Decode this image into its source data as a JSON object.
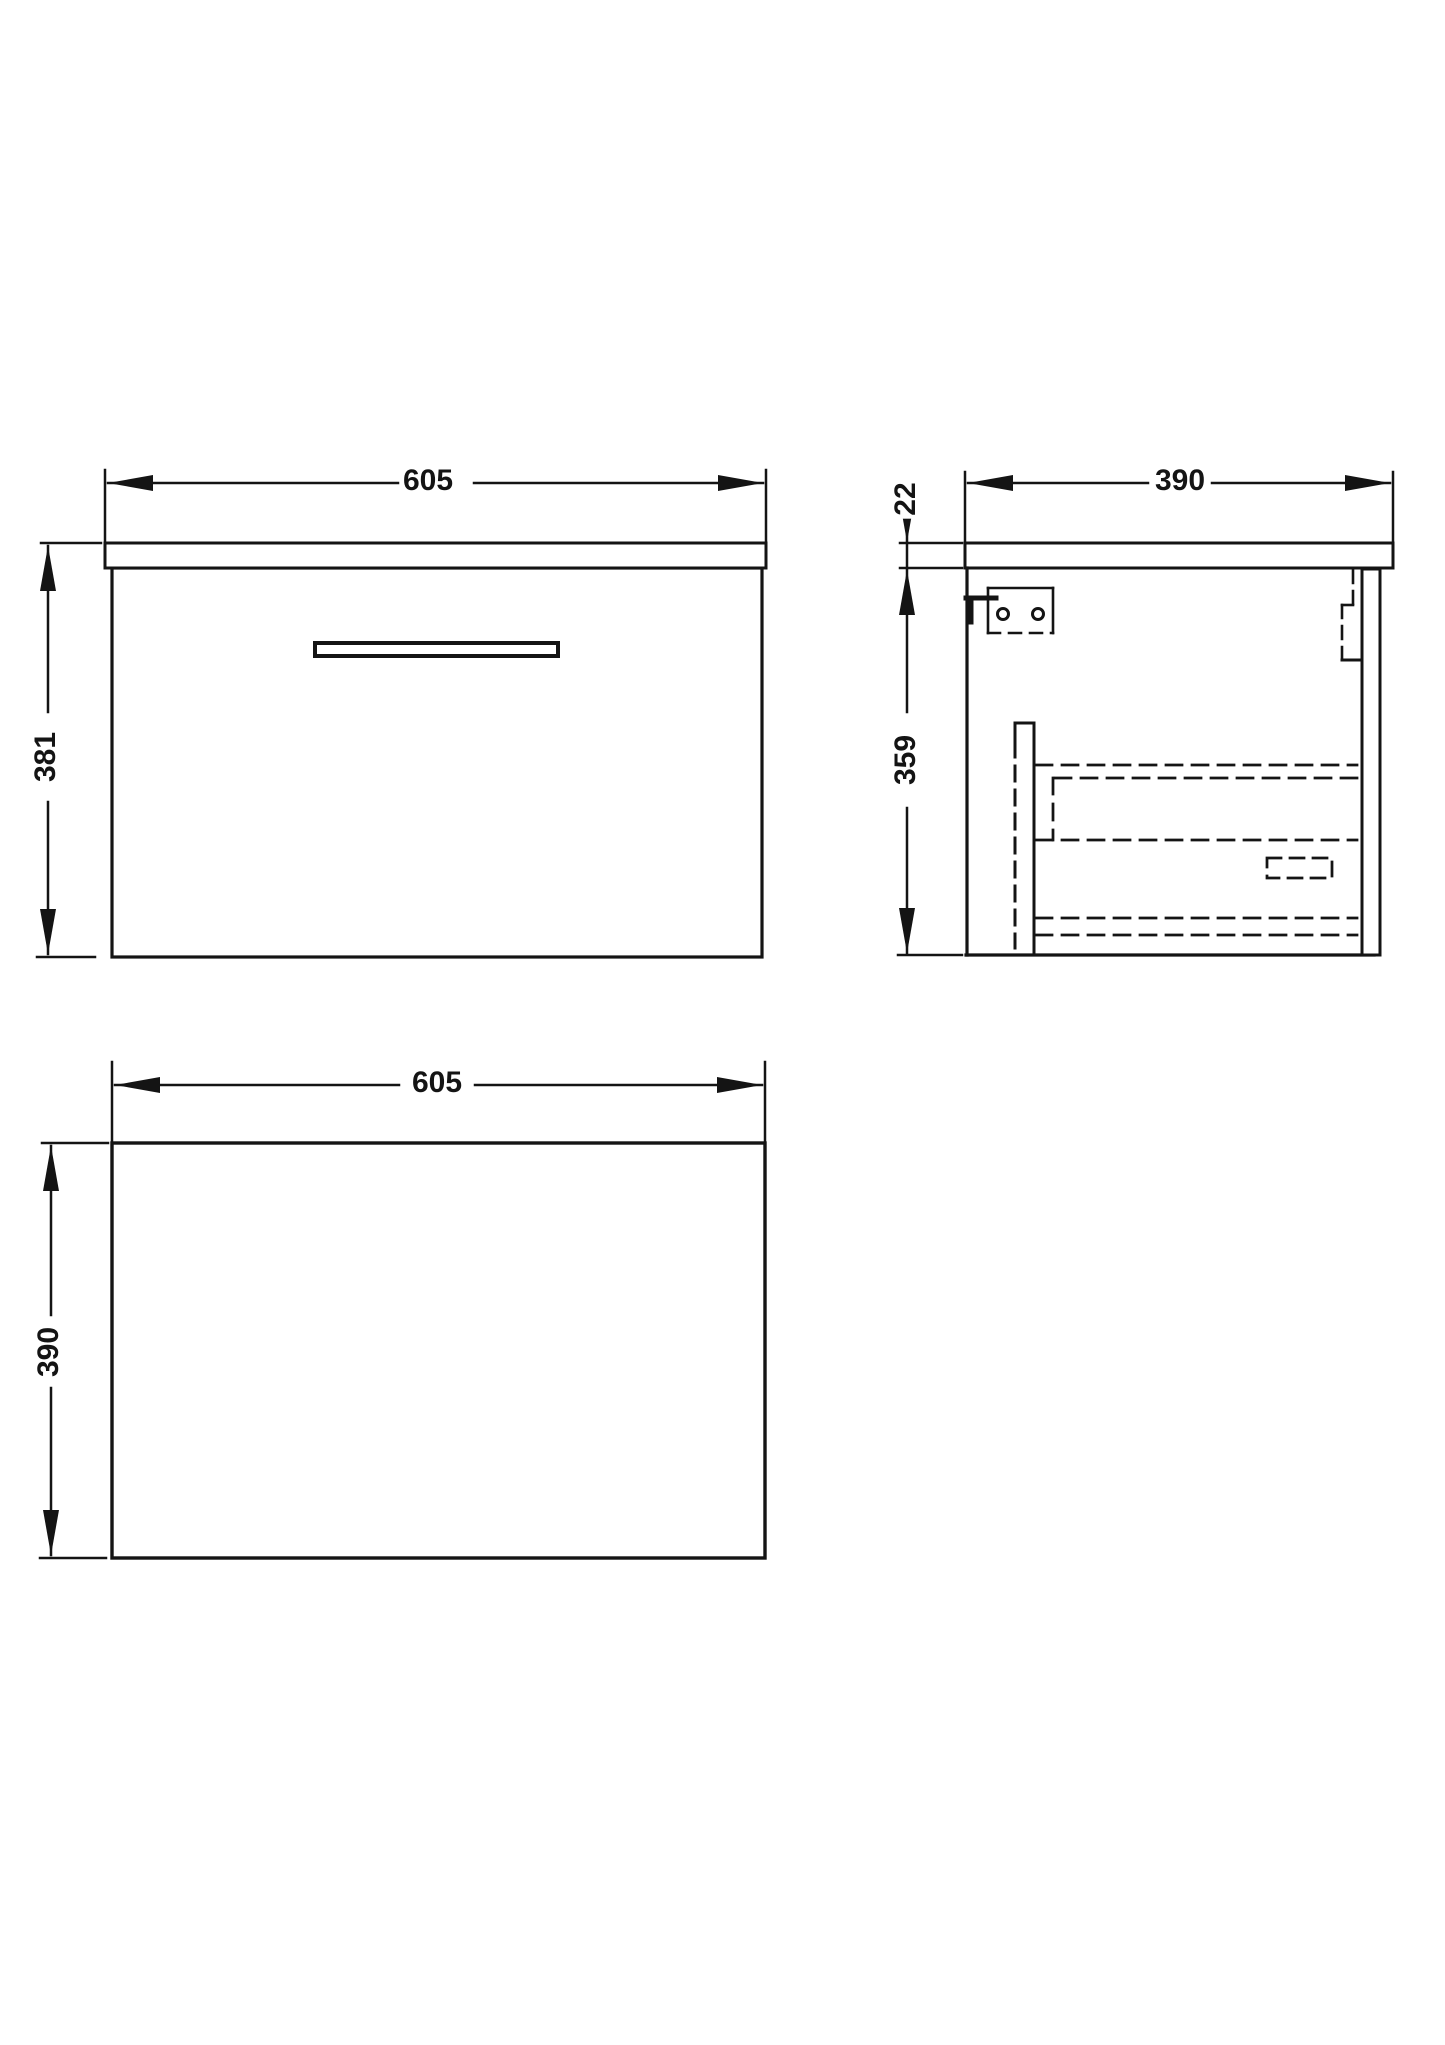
{
  "drawing": {
    "type": "orthographic technical drawing of wall-hung vanity drawer unit",
    "colors": {
      "line": "#141414",
      "background": "#ffffff"
    },
    "views": {
      "front": {
        "width": "605",
        "height": "381"
      },
      "side": {
        "depth": "390",
        "worktop_thickness": "22",
        "cabinet_height": "359"
      },
      "plan": {
        "width": "605",
        "depth": "390"
      }
    }
  }
}
